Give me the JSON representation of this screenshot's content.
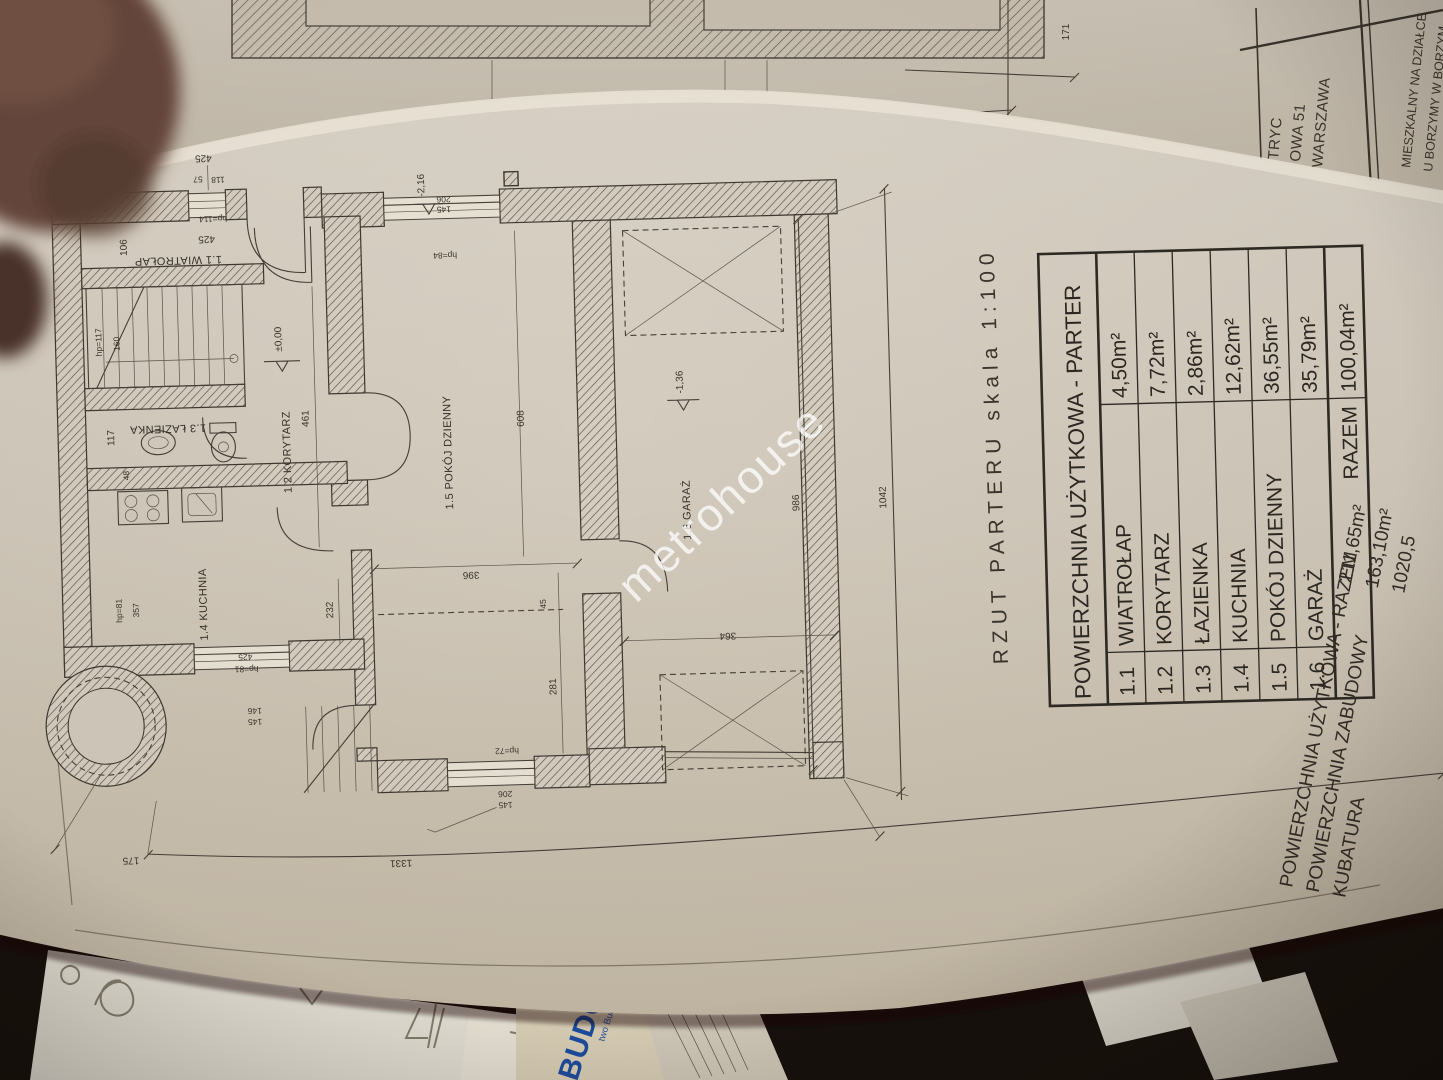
{
  "watermark": "metrohouse",
  "sheet_title": "RZUT PARTERU skala 1:100",
  "area_table": {
    "header": "POWIERZCHNIA UŻYTKOWA - PARTER",
    "rows": [
      {
        "no": "1.1",
        "name": "WIATROŁAP",
        "area": "4,50m²"
      },
      {
        "no": "1.2",
        "name": "KORYTARZ",
        "area": "7,72m²"
      },
      {
        "no": "1.3",
        "name": "ŁAZIENKA",
        "area": "2,86m²"
      },
      {
        "no": "1.4",
        "name": "KUCHNIA",
        "area": "12,62m²"
      },
      {
        "no": "1.5",
        "name": "POKÓJ DZIENNY",
        "area": "36,55m²"
      },
      {
        "no": "1.6",
        "name": "GARAŻ",
        "area": "35,79m²"
      }
    ],
    "total_label": "RAZEM",
    "total_area": "100,04m²"
  },
  "summary": {
    "l1": "POWIERZCHNIA UŻYTKOWA - RAZEM",
    "v1": "211,65m²",
    "l2": "POWIERZCHNIA ZABUDOWY",
    "v2": "163,10m²",
    "l3": "KUBATURA",
    "v3": "1020,5"
  },
  "title_block": {
    "line1": "TRYC",
    "line2": "OWA 51",
    "line3": "WARSZAWA",
    "line4": "MIESZKALNY NA DZIAŁCE",
    "line5": "U BORZYMY W BORZYM"
  },
  "rooms": [
    "1.1 WIATROŁAP",
    "1.2 KORYTARZ",
    "1.3 ŁAZIENKA",
    "1.4 KUCHNIA",
    "1.5 POKÓJ DZIENNY",
    "1.6 GARAŻ"
  ],
  "levels": {
    "zero": "±0,00",
    "garage": "-1,36",
    "entry": "-2,16"
  },
  "dims": {
    "d1042": "1042",
    "d1331": "1331",
    "d986": "986",
    "d499": "499",
    "d440": "440",
    "d171": "171",
    "d175": "175",
    "d608": "608",
    "d461": "461",
    "d396": "396",
    "d364": "364",
    "d281": "281",
    "d425": "425",
    "d357": "357",
    "d232": "232",
    "d117": "117",
    "d106": "106",
    "d160": "160",
    "d90": "90",
    "d48": "48",
    "d45": "45",
    "d57": "57",
    "d118": "118",
    "d206": "206",
    "d145": "145",
    "d146": "146",
    "hp114": "hp=114",
    "hp117": "hp=117",
    "hp84": "hp=84",
    "hp81": "hp=81",
    "hp72": "hp=72"
  },
  "background_papers": {
    "blue_text_large": "BUDOW",
    "blue_text_small": "two Budowl"
  }
}
